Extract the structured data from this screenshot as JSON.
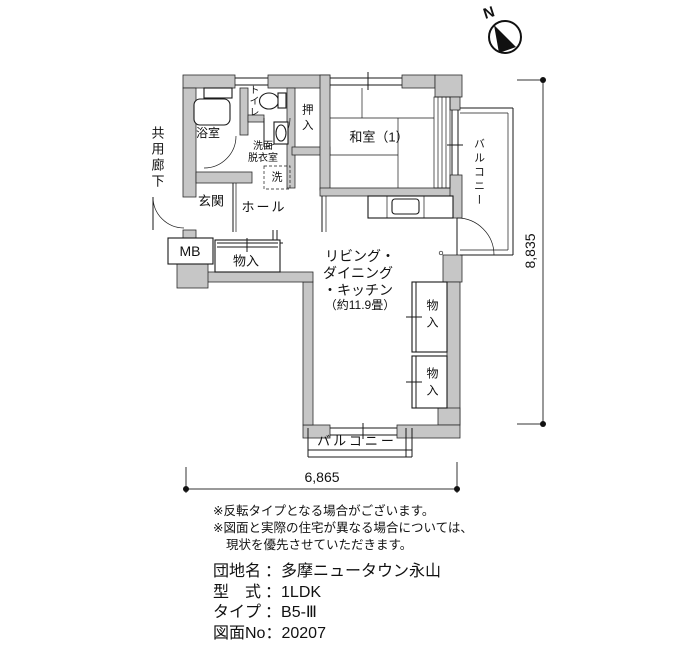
{
  "compass": {
    "north_label": "N"
  },
  "plan": {
    "rooms": {
      "corridor": "共用廊下",
      "bath": "浴室",
      "toilet": "トイレ",
      "washroom_line1": "洗面",
      "washroom_line2": "脱衣室",
      "entrance": "玄関",
      "hall": "ホール",
      "meter_box": "MB",
      "hall_closet": "物入",
      "oshiire": "押入",
      "japanese_room": "和室（1）",
      "ldk_line1": "リビング・",
      "ldk_line2": "ダイニング",
      "ldk_line3": "・キッチン",
      "ldk_line4": "（約11.9畳）",
      "closet_upper": "物入",
      "closet_lower": "物入",
      "balcony_right": "バルコニー",
      "balcony_bottom": "バルコニー"
    },
    "fixtures": {
      "washing_machine": "洗"
    }
  },
  "dimensions": {
    "width_mm": "6,865",
    "height_mm": "8,835"
  },
  "notes": [
    "※反転タイプとなる場合がございます。",
    "※図面と実際の住宅が異なる場合については、",
    "現状を優先させていただきます。"
  ],
  "info": {
    "separator": "：",
    "rows": [
      {
        "label": "団地名",
        "value": "多摩ニュータウン永山"
      },
      {
        "label": "型　式",
        "value": "1LDK"
      },
      {
        "label": "タイプ",
        "value": "B5-Ⅲ"
      },
      {
        "label": "図面No",
        "value": "20207"
      }
    ]
  },
  "colors": {
    "wall_fill": "#c6c6c6",
    "line_color": "#1a1a1a",
    "background": "#ffffff"
  }
}
